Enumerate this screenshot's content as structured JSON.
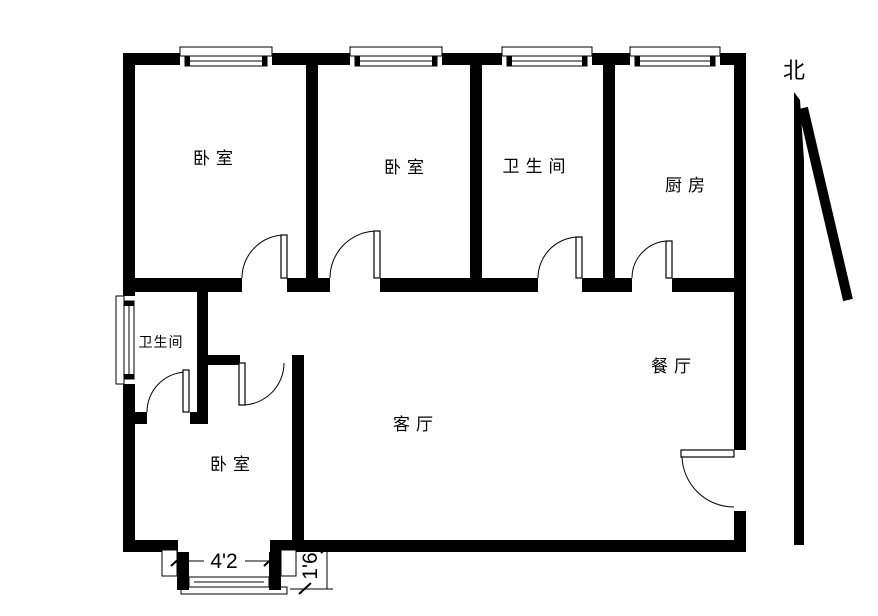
{
  "colors": {
    "wall": "#000000",
    "background": "#ffffff",
    "line": "#000000"
  },
  "rooms": {
    "bedroom_top_left": {
      "label": "卧室"
    },
    "bedroom_top_middle": {
      "label": "卧室"
    },
    "bathroom_top": {
      "label": "卫生间"
    },
    "kitchen": {
      "label": "厨房"
    },
    "bathroom_left": {
      "label": "卫生间"
    },
    "living_room": {
      "label": "客厅"
    },
    "dining_room": {
      "label": "餐厅"
    },
    "bedroom_bottom": {
      "label": "卧室"
    }
  },
  "dimensions": {
    "bay_window_width": "4'2",
    "bay_window_depth": "1'6"
  },
  "compass": {
    "north_label": "北"
  }
}
